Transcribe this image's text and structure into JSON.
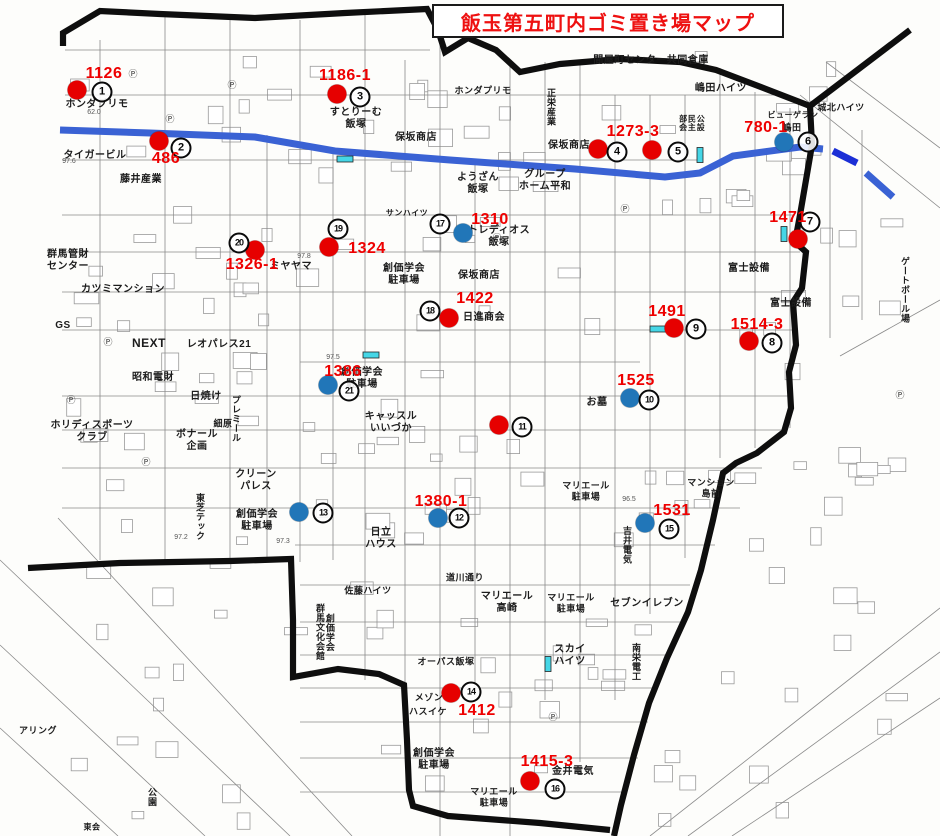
{
  "title": "飯玉第五町内ゴミ置き場マップ",
  "colors": {
    "title_red": "#ee1111",
    "red_marker": "#e60000",
    "blue_marker": "#2176b8",
    "label_red": "#ee0000",
    "road_blue": "#3a62d4",
    "road_blue_dark": "#1b2fd6",
    "cyan_mark": "#45d6e6",
    "border_black": "#0e0e0e",
    "street_gray": "#8a8a8a"
  },
  "markers": [
    {
      "num": "1",
      "type": "red",
      "dot_x": 77,
      "dot_y": 90,
      "circle_x": 102,
      "circle_y": 92,
      "label": "1126",
      "label_x": 104,
      "label_y": 74
    },
    {
      "num": "2",
      "type": "red",
      "dot_x": 159,
      "dot_y": 141,
      "circle_x": 181,
      "circle_y": 148,
      "label": "486",
      "label_x": 166,
      "label_y": 159
    },
    {
      "num": "3",
      "type": "red",
      "dot_x": 337,
      "dot_y": 94,
      "circle_x": 360,
      "circle_y": 97,
      "label": "1186-1",
      "label_x": 345,
      "label_y": 76
    },
    {
      "num": "4",
      "type": "red",
      "dot_x": 598,
      "dot_y": 149,
      "circle_x": 617,
      "circle_y": 152,
      "label": "1273-3",
      "label_x": 633,
      "label_y": 132
    },
    {
      "num": "5",
      "type": "red",
      "dot_x": 652,
      "dot_y": 150,
      "circle_x": 678,
      "circle_y": 152,
      "label": null,
      "label_x": 0,
      "label_y": 0
    },
    {
      "num": "6",
      "type": "blue",
      "dot_x": 784,
      "dot_y": 142,
      "circle_x": 808,
      "circle_y": 142,
      "label": "780-1",
      "label_x": 766,
      "label_y": 128
    },
    {
      "num": "7",
      "type": "red",
      "dot_x": 798,
      "dot_y": 239,
      "circle_x": 810,
      "circle_y": 222,
      "label": "1471",
      "label_x": 788,
      "label_y": 218
    },
    {
      "num": "8",
      "type": "red",
      "dot_x": 749,
      "dot_y": 341,
      "circle_x": 772,
      "circle_y": 343,
      "label": "1514-3",
      "label_x": 757,
      "label_y": 325
    },
    {
      "num": "9",
      "type": "red",
      "dot_x": 674,
      "dot_y": 328,
      "circle_x": 696,
      "circle_y": 329,
      "label": "1491",
      "label_x": 667,
      "label_y": 312
    },
    {
      "num": "10",
      "type": "blue",
      "dot_x": 630,
      "dot_y": 398,
      "circle_x": 649,
      "circle_y": 400,
      "label": "1525",
      "label_x": 636,
      "label_y": 381
    },
    {
      "num": "11",
      "type": "red",
      "dot_x": 499,
      "dot_y": 425,
      "circle_x": 522,
      "circle_y": 427,
      "label": null,
      "label_x": 0,
      "label_y": 0
    },
    {
      "num": "12",
      "type": "blue",
      "dot_x": 438,
      "dot_y": 518,
      "circle_x": 459,
      "circle_y": 518,
      "label": "1380-1",
      "label_x": 441,
      "label_y": 502
    },
    {
      "num": "13",
      "type": "blue",
      "dot_x": 299,
      "dot_y": 512,
      "circle_x": 323,
      "circle_y": 513,
      "label": null,
      "label_x": 0,
      "label_y": 0
    },
    {
      "num": "14",
      "type": "red",
      "dot_x": 451,
      "dot_y": 693,
      "circle_x": 471,
      "circle_y": 692,
      "label": "1412",
      "label_x": 477,
      "label_y": 711
    },
    {
      "num": "15",
      "type": "blue",
      "dot_x": 645,
      "dot_y": 523,
      "circle_x": 669,
      "circle_y": 529,
      "label": "1531",
      "label_x": 672,
      "label_y": 511
    },
    {
      "num": "16",
      "type": "red",
      "dot_x": 530,
      "dot_y": 781,
      "circle_x": 555,
      "circle_y": 789,
      "label": "1415-3",
      "label_x": 547,
      "label_y": 762
    },
    {
      "num": "17",
      "type": "blue",
      "dot_x": 463,
      "dot_y": 233,
      "circle_x": 440,
      "circle_y": 224,
      "label": "1310",
      "label_x": 490,
      "label_y": 220
    },
    {
      "num": "18",
      "type": "red",
      "dot_x": 449,
      "dot_y": 318,
      "circle_x": 430,
      "circle_y": 311,
      "label": "1422",
      "label_x": 475,
      "label_y": 299
    },
    {
      "num": "19",
      "type": "red",
      "dot_x": 329,
      "dot_y": 247,
      "circle_x": 338,
      "circle_y": 229,
      "label": "1324",
      "label_x": 367,
      "label_y": 249
    },
    {
      "num": "20",
      "type": "red",
      "dot_x": 255,
      "dot_y": 250,
      "circle_x": 239,
      "circle_y": 243,
      "label": "1326-1",
      "label_x": 252,
      "label_y": 265
    },
    {
      "num": "21",
      "type": "blue",
      "dot_x": 328,
      "dot_y": 385,
      "circle_x": 349,
      "circle_y": 391,
      "label": "1386",
      "label_x": 343,
      "label_y": 372
    }
  ],
  "cyan_marks": [
    {
      "x": 345,
      "y": 159,
      "orient": "h"
    },
    {
      "x": 700,
      "y": 155,
      "orient": "v"
    },
    {
      "x": 784,
      "y": 234,
      "orient": "v"
    },
    {
      "x": 658,
      "y": 329,
      "orient": "h"
    },
    {
      "x": 371,
      "y": 355,
      "orient": "h"
    },
    {
      "x": 548,
      "y": 664,
      "orient": "v"
    }
  ],
  "place_labels": [
    {
      "text": "ホンダプリモ",
      "x": 97,
      "y": 105,
      "v": false,
      "size": 10
    },
    {
      "text": "タイガービル",
      "x": 95,
      "y": 156,
      "v": false,
      "size": 10
    },
    {
      "text": "藤井産業",
      "x": 141,
      "y": 180,
      "v": false,
      "size": 10
    },
    {
      "text": "群馬管財\nセンター",
      "x": 68,
      "y": 261,
      "v": false,
      "size": 10
    },
    {
      "text": "カツミマンション",
      "x": 123,
      "y": 290,
      "v": false,
      "size": 10
    },
    {
      "text": "GS",
      "x": 63,
      "y": 326,
      "v": false,
      "size": 10
    },
    {
      "text": "NEXT",
      "x": 149,
      "y": 343,
      "v": false,
      "size": 12
    },
    {
      "text": "レオパレス21",
      "x": 219,
      "y": 345,
      "v": false,
      "size": 10
    },
    {
      "text": "昭和電財",
      "x": 153,
      "y": 378,
      "v": false,
      "size": 10
    },
    {
      "text": "日焼け",
      "x": 206,
      "y": 397,
      "v": false,
      "size": 10
    },
    {
      "text": "ホリディスポーツ\nクラブ",
      "x": 92,
      "y": 432,
      "v": false,
      "size": 10
    },
    {
      "text": "細原",
      "x": 223,
      "y": 424,
      "v": false,
      "size": 9
    },
    {
      "text": "プレミール",
      "x": 235,
      "y": 419,
      "v": true,
      "size": 9
    },
    {
      "text": "ボナール\n企画",
      "x": 197,
      "y": 441,
      "v": false,
      "size": 10
    },
    {
      "text": "クリーン\nパレス",
      "x": 256,
      "y": 481,
      "v": false,
      "size": 10
    },
    {
      "text": "東芝テック",
      "x": 199,
      "y": 517,
      "v": true,
      "size": 9
    },
    {
      "text": "創価学会\n駐車場",
      "x": 257,
      "y": 521,
      "v": false,
      "size": 10
    },
    {
      "text": "創価学会\n群馬文化会館",
      "x": 324,
      "y": 632,
      "v": true,
      "size": 9
    },
    {
      "text": "佐藤ハイツ",
      "x": 368,
      "y": 591,
      "v": false,
      "size": 9
    },
    {
      "text": "すとりーむ\n飯塚",
      "x": 356,
      "y": 119,
      "v": false,
      "size": 10
    },
    {
      "text": "保坂商店",
      "x": 416,
      "y": 138,
      "v": false,
      "size": 10
    },
    {
      "text": "保坂商店",
      "x": 569,
      "y": 146,
      "v": false,
      "size": 10
    },
    {
      "text": "保坂商店",
      "x": 479,
      "y": 276,
      "v": false,
      "size": 10
    },
    {
      "text": "ホンダプリモ",
      "x": 483,
      "y": 91,
      "v": false,
      "size": 9
    },
    {
      "text": "間屋町センター共同倉庫",
      "x": 651,
      "y": 61,
      "v": false,
      "size": 10
    },
    {
      "text": "嶋田ハイツ",
      "x": 721,
      "y": 89,
      "v": false,
      "size": 10
    },
    {
      "text": "城北ハイツ",
      "x": 841,
      "y": 108,
      "v": false,
      "size": 9
    },
    {
      "text": "正栄産業",
      "x": 550,
      "y": 107,
      "v": true,
      "size": 9
    },
    {
      "text": "公設\n民主\n部会",
      "x": 691,
      "y": 123,
      "v": true,
      "size": 8
    },
    {
      "text": "ようざん\n飯塚",
      "x": 478,
      "y": 184,
      "v": false,
      "size": 10
    },
    {
      "text": "グループ\nホーム平和",
      "x": 545,
      "y": 181,
      "v": false,
      "size": 10
    },
    {
      "text": "ビューゲラン",
      "x": 793,
      "y": 115,
      "v": false,
      "size": 8
    },
    {
      "text": "嶋田",
      "x": 792,
      "y": 128,
      "v": false,
      "size": 9
    },
    {
      "text": "サンハイツ",
      "x": 407,
      "y": 213,
      "v": false,
      "size": 8
    },
    {
      "text": "トレディオス\n飯塚",
      "x": 499,
      "y": 237,
      "v": false,
      "size": 10
    },
    {
      "text": "創価学会\n駐車場",
      "x": 404,
      "y": 275,
      "v": false,
      "size": 10
    },
    {
      "text": "ミヤヤマ",
      "x": 291,
      "y": 267,
      "v": false,
      "size": 10
    },
    {
      "text": "日進商会",
      "x": 484,
      "y": 318,
      "v": false,
      "size": 10
    },
    {
      "text": "富士設備",
      "x": 749,
      "y": 269,
      "v": false,
      "size": 10
    },
    {
      "text": "富士設備",
      "x": 791,
      "y": 304,
      "v": false,
      "size": 10
    },
    {
      "text": "ゲートボール場",
      "x": 904,
      "y": 290,
      "v": true,
      "size": 9
    },
    {
      "text": "キャッスル\nいいづか",
      "x": 391,
      "y": 423,
      "v": false,
      "size": 10
    },
    {
      "text": "お墓",
      "x": 597,
      "y": 403,
      "v": false,
      "size": 10
    },
    {
      "text": "創価学会\n駐車場",
      "x": 362,
      "y": 379,
      "v": false,
      "size": 10
    },
    {
      "text": "マリエール\n駐車場",
      "x": 586,
      "y": 491,
      "v": false,
      "size": 9
    },
    {
      "text": "吉井電気",
      "x": 626,
      "y": 545,
      "v": true,
      "size": 9
    },
    {
      "text": "マンション\n島前",
      "x": 711,
      "y": 488,
      "v": false,
      "size": 9
    },
    {
      "text": "日立\nハウス",
      "x": 381,
      "y": 539,
      "v": false,
      "size": 10
    },
    {
      "text": "道川通り",
      "x": 465,
      "y": 578,
      "v": false,
      "size": 9
    },
    {
      "text": "マリエール\n高崎",
      "x": 507,
      "y": 603,
      "v": false,
      "size": 10
    },
    {
      "text": "マリエール\n駐車場",
      "x": 571,
      "y": 603,
      "v": false,
      "size": 9
    },
    {
      "text": "セブンイレブン",
      "x": 647,
      "y": 604,
      "v": false,
      "size": 10
    },
    {
      "text": "スカイ\nハイツ",
      "x": 570,
      "y": 656,
      "v": false,
      "size": 10
    },
    {
      "text": "南栄電工",
      "x": 635,
      "y": 662,
      "v": true,
      "size": 9
    },
    {
      "text": "オーパス飯塚",
      "x": 446,
      "y": 662,
      "v": false,
      "size": 9
    },
    {
      "text": "メゾン",
      "x": 429,
      "y": 698,
      "v": false,
      "size": 9
    },
    {
      "text": "ハスイケ",
      "x": 428,
      "y": 712,
      "v": false,
      "size": 9
    },
    {
      "text": "創価学会\n駐車場",
      "x": 434,
      "y": 760,
      "v": false,
      "size": 10
    },
    {
      "text": "金井電気",
      "x": 573,
      "y": 772,
      "v": false,
      "size": 10
    },
    {
      "text": "マリエール\n駐車場",
      "x": 494,
      "y": 797,
      "v": false,
      "size": 9
    },
    {
      "text": "公園",
      "x": 151,
      "y": 797,
      "v": true,
      "size": 9
    },
    {
      "text": "アリング",
      "x": 38,
      "y": 731,
      "v": false,
      "size": 9
    },
    {
      "text": "東会",
      "x": 92,
      "y": 827,
      "v": false,
      "size": 8
    }
  ],
  "p_marks": [
    {
      "x": 133,
      "y": 77
    },
    {
      "x": 170,
      "y": 122
    },
    {
      "x": 232,
      "y": 88
    },
    {
      "x": 108,
      "y": 345
    },
    {
      "x": 71,
      "y": 403
    },
    {
      "x": 146,
      "y": 465
    },
    {
      "x": 553,
      "y": 720
    },
    {
      "x": 900,
      "y": 398
    },
    {
      "x": 497,
      "y": 241
    },
    {
      "x": 625,
      "y": 212
    }
  ],
  "elevation_marks": [
    {
      "text": "97.6",
      "x": 69,
      "y": 163
    },
    {
      "text": "62.0",
      "x": 94,
      "y": 114
    },
    {
      "text": "97.8",
      "x": 304,
      "y": 258
    },
    {
      "text": "97.5",
      "x": 333,
      "y": 359
    },
    {
      "text": "97.2",
      "x": 181,
      "y": 539
    },
    {
      "text": "97.3",
      "x": 283,
      "y": 543
    },
    {
      "text": "96.5",
      "x": 629,
      "y": 501
    }
  ],
  "map_geometry": {
    "blue_road": [
      [
        60,
        130
      ],
      [
        150,
        133
      ],
      [
        255,
        137
      ],
      [
        335,
        151
      ],
      [
        450,
        160
      ],
      [
        575,
        169
      ],
      [
        665,
        177
      ],
      [
        700,
        173
      ],
      [
        733,
        156
      ],
      [
        800,
        147
      ],
      [
        823,
        149
      ]
    ],
    "blue_dashes": [
      {
        "pts": [
          [
            833,
            151
          ],
          [
            857,
            163
          ]
        ],
        "dark": true
      },
      {
        "pts": [
          [
            866,
            173
          ],
          [
            893,
            197
          ]
        ],
        "dark": false
      }
    ],
    "border_paths": [
      [
        [
          63,
          46
        ],
        [
          63,
          33
        ],
        [
          100,
          11
        ],
        [
          160,
          14
        ],
        [
          255,
          18
        ],
        [
          345,
          13
        ],
        [
          427,
          9
        ],
        [
          438,
          30
        ],
        [
          445,
          52
        ],
        [
          468,
          38
        ],
        [
          496,
          50
        ],
        [
          520,
          72
        ],
        [
          560,
          64
        ],
        [
          620,
          59
        ],
        [
          680,
          62
        ],
        [
          716,
          70
        ],
        [
          766,
          89
        ],
        [
          810,
          106
        ],
        [
          910,
          30
        ]
      ],
      [
        [
          810,
          106
        ],
        [
          812,
          145
        ],
        [
          806,
          180
        ],
        [
          800,
          215
        ],
        [
          795,
          242
        ],
        [
          806,
          252
        ],
        [
          802,
          288
        ],
        [
          793,
          302
        ],
        [
          796,
          345
        ],
        [
          789,
          372
        ],
        [
          791,
          408
        ],
        [
          784,
          432
        ],
        [
          757,
          453
        ],
        [
          736,
          463
        ],
        [
          723,
          473
        ],
        [
          713,
          520
        ],
        [
          701,
          570
        ],
        [
          688,
          612
        ],
        [
          667,
          658
        ],
        [
          649,
          703
        ],
        [
          634,
          755
        ],
        [
          621,
          805
        ],
        [
          614,
          836
        ]
      ],
      [
        [
          28,
          568
        ],
        [
          120,
          563
        ],
        [
          230,
          561
        ],
        [
          291,
          559
        ],
        [
          293,
          620
        ],
        [
          293,
          677
        ],
        [
          338,
          669
        ],
        [
          379,
          674
        ],
        [
          404,
          685
        ],
        [
          407,
          740
        ],
        [
          409,
          790
        ],
        [
          413,
          806
        ],
        [
          448,
          816
        ],
        [
          540,
          823
        ],
        [
          610,
          830
        ]
      ]
    ],
    "streets": [
      [
        100,
        40,
        100,
        560
      ],
      [
        165,
        14,
        165,
        565
      ],
      [
        230,
        18,
        230,
        562
      ],
      [
        267,
        135,
        267,
        560
      ],
      [
        300,
        20,
        300,
        562
      ],
      [
        333,
        152,
        333,
        560
      ],
      [
        365,
        14,
        365,
        680
      ],
      [
        405,
        60,
        405,
        682
      ],
      [
        440,
        12,
        440,
        836
      ],
      [
        475,
        160,
        475,
        692
      ],
      [
        510,
        60,
        510,
        836
      ],
      [
        545,
        62,
        545,
        700
      ],
      [
        580,
        64,
        580,
        762
      ],
      [
        615,
        95,
        615,
        700
      ],
      [
        650,
        95,
        650,
        614
      ],
      [
        685,
        95,
        685,
        558
      ],
      [
        720,
        68,
        720,
        458
      ],
      [
        755,
        92,
        755,
        448
      ],
      [
        790,
        108,
        790,
        428
      ],
      [
        830,
        112,
        830,
        338
      ],
      [
        862,
        130,
        862,
        320
      ],
      [
        65,
        50,
        430,
        50
      ],
      [
        65,
        95,
        775,
        95
      ],
      [
        62,
        160,
        700,
        160
      ],
      [
        62,
        215,
        795,
        215
      ],
      [
        62,
        252,
        800,
        252
      ],
      [
        62,
        292,
        805,
        292
      ],
      [
        62,
        330,
        792,
        330
      ],
      [
        300,
        362,
        640,
        362
      ],
      [
        62,
        396,
        788,
        396
      ],
      [
        62,
        430,
        782,
        430
      ],
      [
        62,
        468,
        762,
        468
      ],
      [
        62,
        508,
        740,
        508
      ],
      [
        295,
        545,
        715,
        545
      ],
      [
        300,
        585,
        690,
        585
      ],
      [
        300,
        622,
        680,
        622
      ],
      [
        300,
        655,
        670,
        655
      ],
      [
        300,
        688,
        658,
        688
      ],
      [
        300,
        722,
        648,
        722
      ],
      [
        300,
        758,
        638,
        758
      ],
      [
        300,
        792,
        624,
        792
      ],
      [
        0,
        560,
        290,
        836
      ],
      [
        0,
        645,
        205,
        836
      ],
      [
        0,
        728,
        118,
        836
      ],
      [
        58,
        518,
        352,
        836
      ],
      [
        650,
        836,
        940,
        608
      ],
      [
        688,
        836,
        940,
        652
      ],
      [
        732,
        836,
        940,
        698
      ],
      [
        800,
        95,
        940,
        208
      ],
      [
        826,
        62,
        940,
        148
      ],
      [
        840,
        356,
        940,
        300
      ]
    ]
  }
}
